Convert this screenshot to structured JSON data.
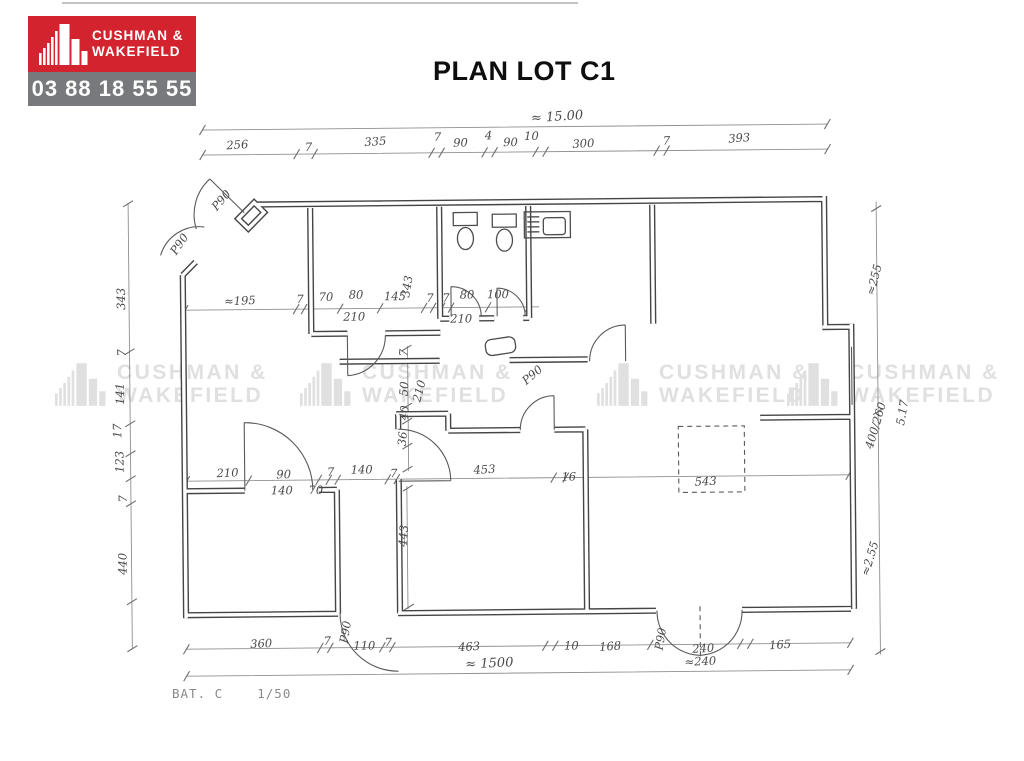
{
  "header": {
    "logo": {
      "brand_line1": "CUSHMAN &",
      "brand_line2": "WAKEFIELD",
      "phone": "03 88 18 55 55",
      "colors": {
        "brand_bg": "#d2232e",
        "phone_bg": "#77797c",
        "text": "#ffffff"
      }
    },
    "title": "PLAN LOT C1"
  },
  "watermark": {
    "line1": "CUSHMAN &",
    "line2": "WAKEFIELD"
  },
  "plan": {
    "scale_note": "BAT. C    1/50",
    "ink_color": "#454545",
    "overall_width_top": "≈ 15.00",
    "overall_width_bottom": "≈ 1500",
    "dim_labels": [
      {
        "t": "256",
        "x": 240,
        "y": 146,
        "r": -3
      },
      {
        "t": "7",
        "x": 311,
        "y": 149
      },
      {
        "t": "335",
        "x": 378,
        "y": 144,
        "r": -3
      },
      {
        "t": "7",
        "x": 440,
        "y": 140
      },
      {
        "t": "90",
        "x": 463,
        "y": 146
      },
      {
        "t": "4",
        "x": 491,
        "y": 139
      },
      {
        "t": "90",
        "x": 513,
        "y": 146
      },
      {
        "t": "10",
        "x": 534,
        "y": 140
      },
      {
        "t": "300",
        "x": 586,
        "y": 148,
        "r": -2
      },
      {
        "t": "7",
        "x": 669,
        "y": 146
      },
      {
        "t": "393",
        "x": 742,
        "y": 144,
        "r": -4
      },
      {
        "t": "≈ 15.00",
        "x": 560,
        "y": 121,
        "r": -3,
        "s": "lg"
      },
      {
        "t": "343",
        "x": 126,
        "y": 295,
        "r": -90
      },
      {
        "t": "7",
        "x": 126,
        "y": 349,
        "r": -90
      },
      {
        "t": "141",
        "x": 124,
        "y": 390,
        "r": -90
      },
      {
        "t": "17",
        "x": 121,
        "y": 427,
        "r": -90
      },
      {
        "t": "123",
        "x": 123,
        "y": 458,
        "r": -90
      },
      {
        "t": "7",
        "x": 126,
        "y": 495,
        "r": -90
      },
      {
        "t": "440",
        "x": 125,
        "y": 560,
        "r": -90
      },
      {
        "t": "≈255",
        "x": 879,
        "y": 284,
        "r": -75
      },
      {
        "t": "400/260",
        "x": 879,
        "y": 430,
        "r": -73
      },
      {
        "t": "5.17",
        "x": 906,
        "y": 417,
        "r": -80
      },
      {
        "t": "≈2.55",
        "x": 872,
        "y": 563,
        "r": -73
      },
      {
        "t": "≈195",
        "x": 241,
        "y": 302,
        "r": -2
      },
      {
        "t": "7",
        "x": 301,
        "y": 301
      },
      {
        "t": "70",
        "x": 327,
        "y": 299
      },
      {
        "t": "80",
        "x": 357,
        "y": 297
      },
      {
        "t": "210",
        "x": 355,
        "y": 319
      },
      {
        "t": "145",
        "x": 396,
        "y": 299
      },
      {
        "t": "7",
        "x": 431,
        "y": 301
      },
      {
        "t": "7",
        "x": 447,
        "y": 301
      },
      {
        "t": "80",
        "x": 468,
        "y": 298
      },
      {
        "t": "100",
        "x": 499,
        "y": 298
      },
      {
        "t": "210",
        "x": 462,
        "y": 322
      },
      {
        "t": "343",
        "x": 412,
        "y": 286,
        "r": -80
      },
      {
        "t": "7",
        "x": 408,
        "y": 352,
        "r": -85
      },
      {
        "t": "50",
        "x": 408,
        "y": 388,
        "r": -85
      },
      {
        "t": "210",
        "x": 423,
        "y": 391,
        "r": -75
      },
      {
        "t": "40",
        "x": 408,
        "y": 412,
        "r": -85
      },
      {
        "t": "36",
        "x": 406,
        "y": 438,
        "r": -85
      },
      {
        "t": "443",
        "x": 406,
        "y": 535,
        "r": -85
      },
      {
        "t": "210",
        "x": 227,
        "y": 474,
        "r": -2
      },
      {
        "t": "90",
        "x": 283,
        "y": 476
      },
      {
        "t": "140",
        "x": 281,
        "y": 492
      },
      {
        "t": "70",
        "x": 315,
        "y": 492
      },
      {
        "t": "7",
        "x": 330,
        "y": 474
      },
      {
        "t": "140",
        "x": 361,
        "y": 472
      },
      {
        "t": "7",
        "x": 393,
        "y": 476
      },
      {
        "t": "453",
        "x": 484,
        "y": 473,
        "r": -3
      },
      {
        "t": "16",
        "x": 568,
        "y": 481
      },
      {
        "t": "543",
        "x": 705,
        "y": 487,
        "r": -2
      },
      {
        "t": "360",
        "x": 259,
        "y": 645,
        "r": -2
      },
      {
        "t": "7",
        "x": 325,
        "y": 643
      },
      {
        "t": "P90",
        "x": 347,
        "y": 631,
        "r": -80
      },
      {
        "t": "110",
        "x": 362,
        "y": 648
      },
      {
        "t": "7",
        "x": 386,
        "y": 645
      },
      {
        "t": "463",
        "x": 467,
        "y": 650,
        "r": -3
      },
      {
        "t": "10",
        "x": 569,
        "y": 650
      },
      {
        "t": "168",
        "x": 608,
        "y": 651,
        "r": -3
      },
      {
        "t": "P90",
        "x": 662,
        "y": 641,
        "r": -80
      },
      {
        "t": "240",
        "x": 701,
        "y": 654,
        "r": -3
      },
      {
        "t": "≈240",
        "x": 698,
        "y": 667,
        "r": -2
      },
      {
        "t": "165",
        "x": 778,
        "y": 651,
        "r": -3
      },
      {
        "t": "≈ 1500",
        "x": 487,
        "y": 667,
        "r": -2,
        "s": "lg"
      },
      {
        "t": "P90",
        "x": 226,
        "y": 200,
        "r": -48
      },
      {
        "t": "P90",
        "x": 184,
        "y": 243,
        "r": -55
      },
      {
        "t": "P90",
        "x": 535,
        "y": 378,
        "r": -40
      }
    ]
  }
}
